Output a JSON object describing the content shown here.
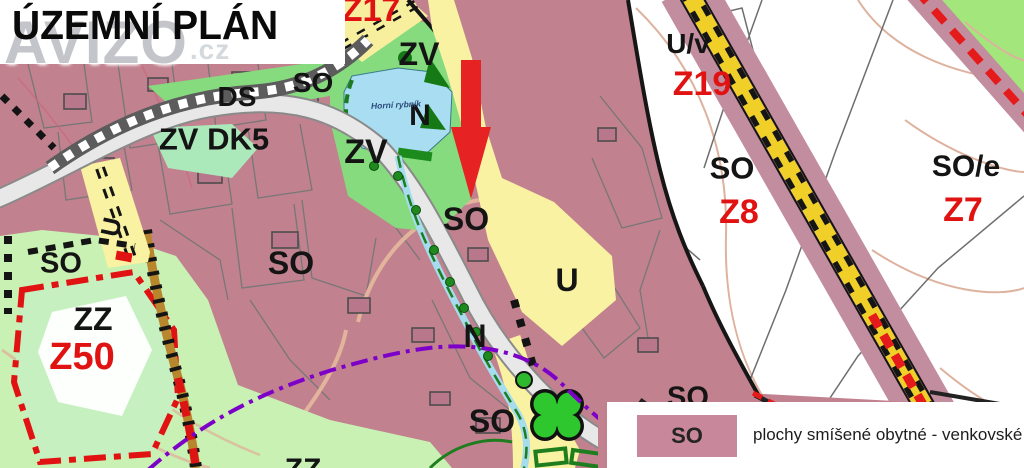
{
  "banner": {
    "title": "ÚZEMNÍ PLÁN"
  },
  "watermark": {
    "text": "AVIZO",
    "suffix": ".cz"
  },
  "map_labels": {
    "z17": "Z17",
    "zv_top": "ZV",
    "n_pond": "N",
    "pond_name": "Horní rybník",
    "zv_left": "ZV",
    "so_top": "SO",
    "ds": "DS",
    "zv_dk5": "ZV DK5",
    "so_left": "SO",
    "so_center": "SO",
    "u_center": "U",
    "n_center": "N",
    "so_bottom": "SO",
    "u_rotated": "U",
    "so_farleft": "SO",
    "zz": "ZZ",
    "z50": "Z50",
    "uv": "U/v",
    "z19": "Z19",
    "so_z8": "SO",
    "z8": "Z8",
    "so_e": "SO/e",
    "z7": "Z7",
    "so_cut": "SO",
    "zz_cut": "ZZ"
  },
  "legend": {
    "swatch_label": "SO",
    "description": "plochy smíšené obytné - venkovské",
    "swatch_color": "#c9879c"
  },
  "colors": {
    "zone_pink": "#c2818f",
    "zone_green_bright": "#86db7e",
    "zone_green_pale": "#c9f1b4",
    "zone_yellow": "#f8f2a2",
    "water_blue": "#a9def2",
    "marker_red": "#e62222",
    "boundary_red": "#e01212",
    "utility_purple": "#7d00c8",
    "corridor_yellow": "#f0d028"
  }
}
